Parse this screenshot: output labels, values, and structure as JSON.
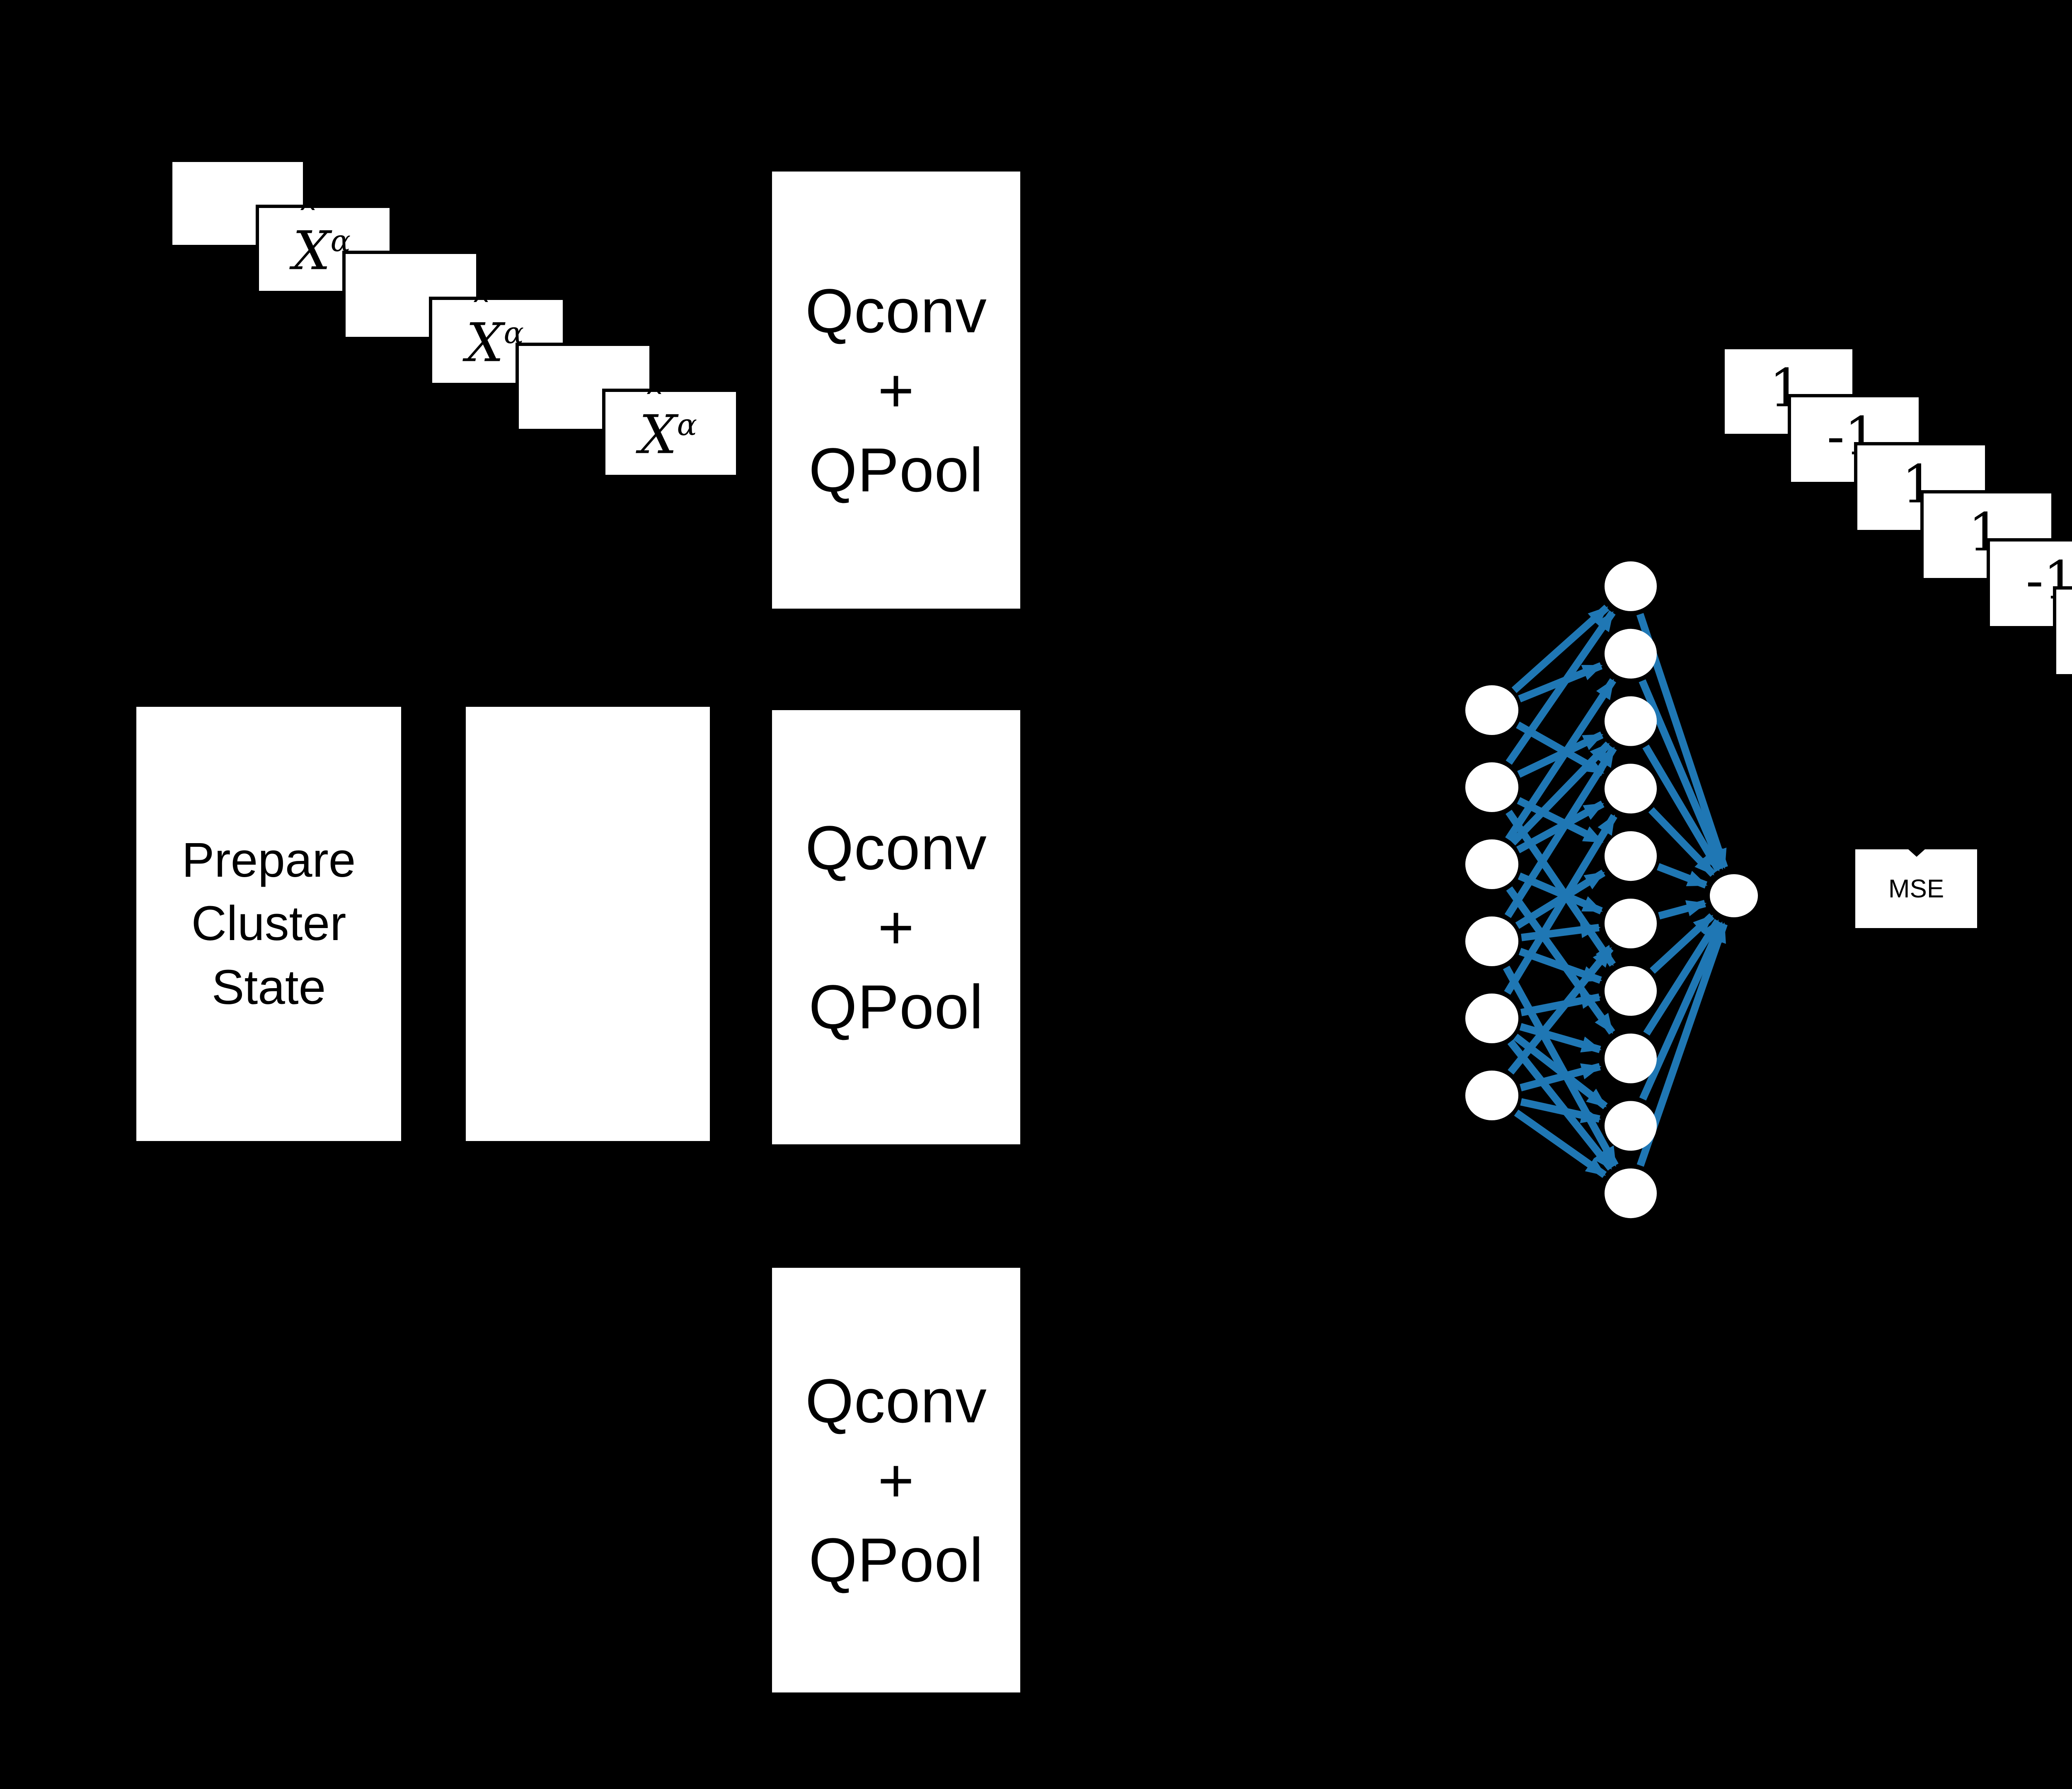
{
  "title": "quantum-convolutional-network-diagram",
  "colors": {
    "background": "#000000",
    "box_fill": "#ffffff",
    "box_text": "#000000",
    "edge_blue": "#1f77b4",
    "node_fill": "#ffffff"
  },
  "input_stack": {
    "card_count": 6,
    "label_base": "X",
    "label_hat": "ˆ",
    "label_superscript": "α",
    "labeled_card_indexes": [
      1,
      3,
      5
    ]
  },
  "prepare_box": {
    "line1": "Prepare",
    "line2": "Cluster",
    "line3": "State"
  },
  "blank_box": {},
  "qconv": {
    "line1": "Qconv",
    "line2": "+",
    "line3": "QPool",
    "block_count": 3
  },
  "network": {
    "input_count": 6,
    "hidden_count": 10,
    "output_count": 1,
    "edges_input_hidden": [
      [
        0,
        0
      ],
      [
        0,
        1
      ],
      [
        0,
        3
      ],
      [
        1,
        0
      ],
      [
        1,
        2
      ],
      [
        1,
        4
      ],
      [
        1,
        6
      ],
      [
        2,
        1
      ],
      [
        2,
        2
      ],
      [
        2,
        3
      ],
      [
        2,
        5
      ],
      [
        2,
        7
      ],
      [
        3,
        2
      ],
      [
        3,
        4
      ],
      [
        3,
        5
      ],
      [
        3,
        6
      ],
      [
        3,
        9
      ],
      [
        4,
        3
      ],
      [
        4,
        6
      ],
      [
        4,
        7
      ],
      [
        4,
        8
      ],
      [
        4,
        9
      ],
      [
        5,
        5
      ],
      [
        5,
        7
      ],
      [
        5,
        8
      ],
      [
        5,
        9
      ]
    ],
    "edges_hidden_output": [
      [
        0,
        0
      ],
      [
        1,
        0
      ],
      [
        2,
        0
      ],
      [
        3,
        0
      ],
      [
        4,
        0
      ],
      [
        5,
        0
      ],
      [
        6,
        0
      ],
      [
        7,
        0
      ],
      [
        8,
        0
      ],
      [
        9,
        0
      ]
    ]
  },
  "output_stack": {
    "card_count": 6,
    "labels": [
      "1",
      "-1",
      "1",
      "1",
      "-1",
      "1"
    ]
  },
  "mse_box": {
    "label": "MSE"
  }
}
